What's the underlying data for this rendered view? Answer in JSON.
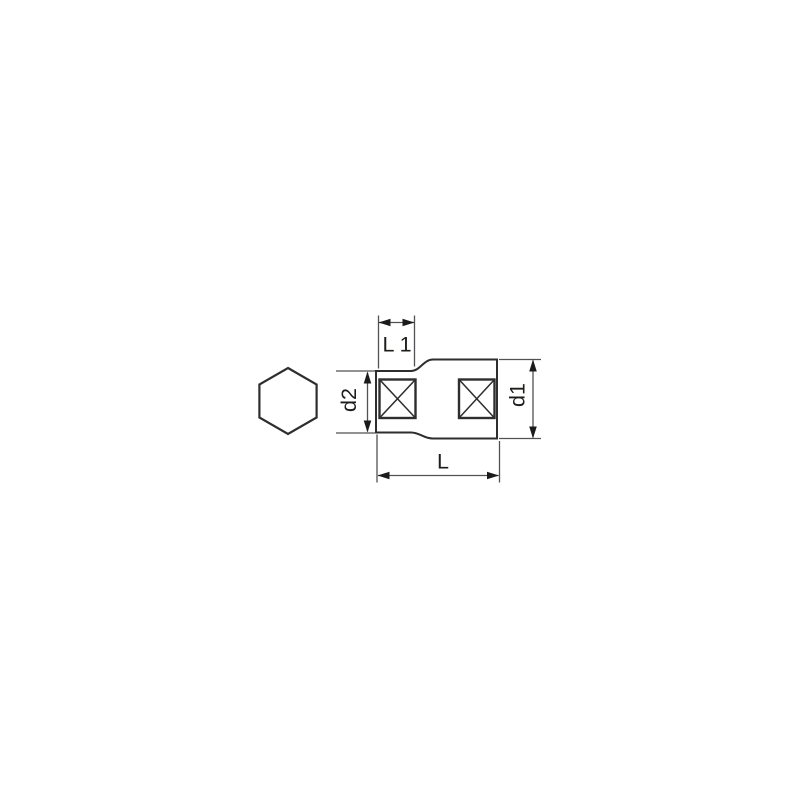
{
  "page": {
    "background_color": "#ffffff"
  },
  "drawing": {
    "kind": "socket-side-view-dimensional-drawing",
    "labels": {
      "l1": "L 1",
      "d2": "d2",
      "d1": "d1",
      "l": "L"
    },
    "icons": {
      "hexagon": "hexagon-outline"
    },
    "colors": {
      "outline": "#2e2e2e",
      "dimension": "#515156",
      "arrow": "#1b1b1b",
      "text": "#1c1c1a",
      "fill": "#ffffff"
    }
  }
}
